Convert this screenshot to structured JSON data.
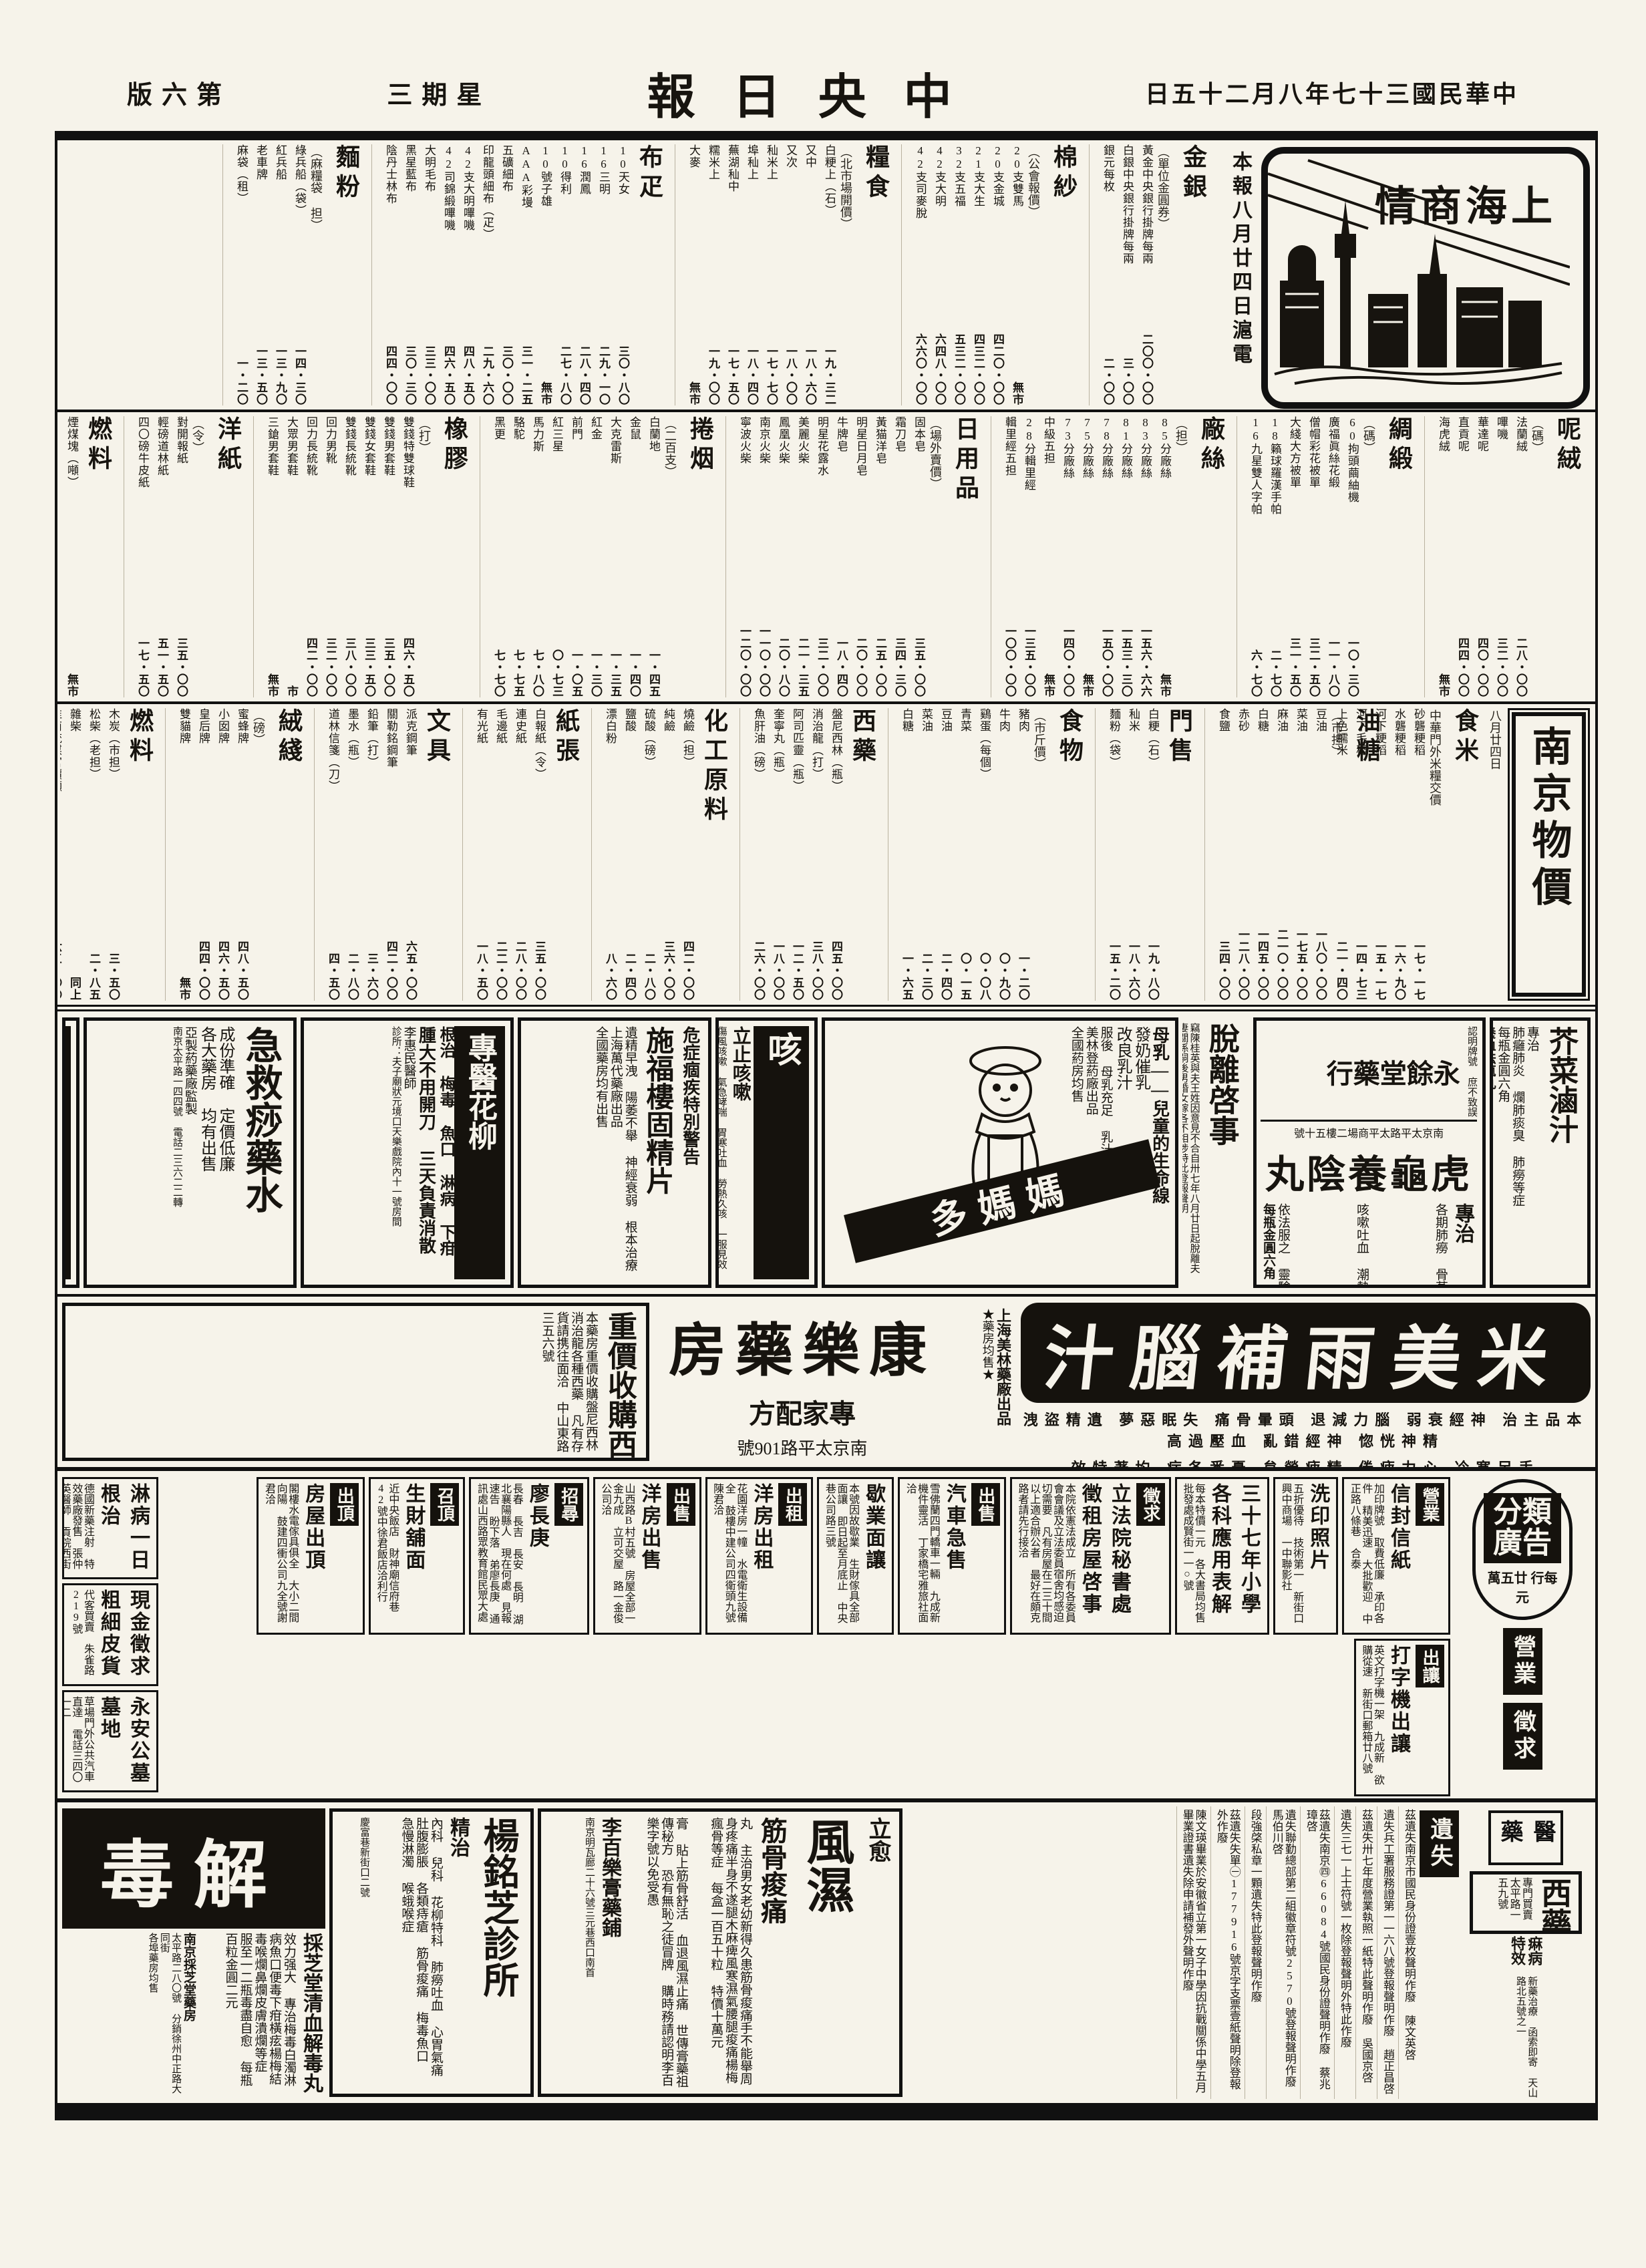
{
  "masthead": {
    "page": "第六版",
    "weekday": "星期三",
    "title": "中央日報",
    "date": "中華民國三十七年八月二十五日"
  },
  "shanghai": {
    "box_title": "上海商情",
    "dateline": "本報八月廿四日滬電"
  },
  "nanjing": {
    "box_title": "南京物價",
    "date": "八月廿四日",
    "sub": "食米",
    "note": "中華門外米糧交價",
    "items": [
      [
        "砂礱粳稻",
        "一七・一七"
      ],
      [
        "水礱粳稻",
        "一六・九〇"
      ],
      [
        "河下粳稻",
        "一五・一七"
      ],
      [
        "河下毛稻",
        "一四・七三"
      ],
      [
        "上色糯米",
        "二一・四〇"
      ]
    ]
  },
  "market": {
    "bands": [
      [
        {
          "t": "金銀",
          "n": "單位金圓券",
          "items": [
            [
              "黃金中央銀行掛牌每兩",
              "二〇〇・〇〇"
            ],
            [
              "白銀中央銀行掛牌每兩",
              "三・〇〇"
            ],
            [
              "銀元每枚",
              "二・〇〇"
            ]
          ]
        },
        {
          "t": "棉紗",
          "n": "公會報價",
          "items": [
            [
              "20支雙馬",
              "無市"
            ],
            [
              "20支金城",
              "四二〇・〇〇"
            ],
            [
              "21支大生",
              "四三二・〇〇"
            ],
            [
              "32支五福",
              "五三二・〇〇"
            ],
            [
              "42支大明",
              "六四八・〇〇"
            ],
            [
              "42支司麥脫",
              "六六〇・〇〇"
            ]
          ]
        },
        {
          "t": "糧食",
          "n": "北市場開價",
          "items": [
            [
              "白粳上（石）",
              "一九・三二"
            ],
            [
              "又中",
              "一八・六〇"
            ],
            [
              "又次",
              "一八・〇〇"
            ],
            [
              "秈米上",
              "一七・七〇"
            ],
            [
              "埠秈上",
              "一八・四〇"
            ],
            [
              "蕪湖秈中",
              "一七・五〇"
            ],
            [
              "糯米上",
              "一九・〇〇"
            ],
            [
              "大麥",
              "無市"
            ]
          ]
        },
        {
          "t": "布疋",
          "n": "",
          "items": [
            [
              "10天女",
              "三〇・八〇"
            ],
            [
              "16三明",
              "二九・一〇"
            ],
            [
              "16潤鳳",
              "二八・四〇"
            ],
            [
              "10得利",
              "二七・八〇"
            ],
            [
              "10號子雄",
              "無市"
            ],
            [
              "AAA彩墁",
              "三一・二五"
            ],
            [
              "五礦細布",
              "三〇・〇〇"
            ],
            [
              "印龍頭細布（疋）",
              "二九・六〇"
            ],
            [
              "42支大明嗶嘰",
              "四八・五〇"
            ],
            [
              "42司錦緞嗶嘰",
              "四六・五〇"
            ],
            [
              "大明毛布",
              "三三・〇〇"
            ],
            [
              "黑星藍布",
              "三〇・三〇"
            ],
            [
              "陰丹士林布",
              "四四・〇〇"
            ]
          ]
        },
        {
          "t": "麵粉",
          "n": "麻糧袋 担",
          "items": [
            [
              "綠兵船（袋）",
              "一四・三〇"
            ],
            [
              "紅兵船",
              "一三・九〇"
            ],
            [
              "老車牌",
              "一三・五〇"
            ],
            [
              "麻袋（租）",
              "一・二〇"
            ]
          ]
        }
      ],
      [
        {
          "t": "呢絨",
          "n": "碼",
          "items": [
            [
              "法蘭絨",
              "二八・〇〇"
            ],
            [
              "嗶嘰",
              "三二・〇〇"
            ],
            [
              "華達呢",
              "四〇・〇〇"
            ],
            [
              "直貢呢",
              "四四・〇〇"
            ],
            [
              "海虎絨",
              "無市"
            ]
          ]
        },
        {
          "t": "綢緞",
          "n": "碼",
          "items": [
            [
              "60拘頭繭紬機",
              "一〇・三〇"
            ],
            [
              "廣福眞絲花緞",
              "一一・八〇"
            ],
            [
              "僧帽彩花被單",
              "三二・五〇"
            ],
            [
              "大綫大方被單",
              "三一・五〇"
            ],
            [
              "18籟球羅漢手帕",
              "二・七〇"
            ],
            [
              "16九星雙人字帕",
              "六・七〇"
            ]
          ]
        },
        {
          "t": "廠絲",
          "n": "担",
          "items": [
            [
              "85分廠絲",
              "無市"
            ],
            [
              "83分廠絲",
              "一五六・六六"
            ],
            [
              "81分廠絲",
              "一五三・三〇"
            ],
            [
              "78分廠絲",
              "一五〇・〇〇"
            ],
            [
              "75分廠絲",
              "無市"
            ],
            [
              "73分廠絲",
              "一四〇・〇〇"
            ],
            [
              "中級五担",
              "無市"
            ],
            [
              "28分輯里經",
              "一三五・〇〇"
            ],
            [
              "輯里經五担",
              "一〇〇・〇〇"
            ]
          ]
        },
        {
          "t": "日用品",
          "n": "場外賣價",
          "items": [
            [
              "固本皂",
              "三五・〇〇"
            ],
            [
              "霜刀皂",
              "三四・三〇"
            ],
            [
              "黃猫洋皂",
              "二五・〇〇"
            ],
            [
              "明星日月皂",
              "二〇・〇〇"
            ],
            [
              "牛牌皂",
              "一八・四〇"
            ],
            [
              "明星花露水",
              "三二・〇〇"
            ],
            [
              "美麗火柴",
              "二一・三五"
            ],
            [
              "鳳凰火柴",
              "二〇・八〇"
            ],
            [
              "南京火柴",
              "一一〇・〇〇"
            ],
            [
              "寧波火柴",
              "一二〇・〇〇"
            ]
          ]
        },
        {
          "t": "捲烟",
          "n": "二百支",
          "items": [
            [
              "白蘭地",
              "一・四五"
            ],
            [
              "金鼠",
              "一・四〇"
            ],
            [
              "大克雷斯",
              "一・三五"
            ],
            [
              "紅金",
              "一・三〇"
            ],
            [
              "前門",
              "一・〇五"
            ],
            [
              "紅三星",
              "〇・七三"
            ],
            [
              "馬力斯",
              "七・八〇"
            ],
            [
              "駱駝",
              "七・七五"
            ],
            [
              "黑更",
              "七・七〇"
            ]
          ]
        },
        {
          "t": "橡膠",
          "n": "打",
          "items": [
            [
              "雙錢特雙球鞋",
              "四六・五〇"
            ],
            [
              "雙錢男套鞋",
              "三五・〇〇"
            ],
            [
              "雙錢女套鞋",
              "三三・五〇"
            ],
            [
              "雙錢長統靴",
              "三八・〇〇"
            ],
            [
              "回力男靴",
              "三二・〇〇"
            ],
            [
              "回力長統靴",
              "四二・〇〇"
            ],
            [
              "大眾男套鞋",
              "市"
            ],
            [
              "三鎗男套鞋",
              "無市"
            ]
          ]
        },
        {
          "t": "洋紙",
          "n": "令",
          "items": [
            [
              "對開報紙",
              "三五・〇〇"
            ],
            [
              "輕磅道林紙",
              "五一・五〇"
            ],
            [
              "四〇磅牛皮紙",
              "一七・五〇"
            ]
          ]
        },
        {
          "t": "燃料",
          "n": "",
          "items": [
            [
              "煙煤塊（噸）",
              "無市"
            ],
            [
              "烏炭（担）",
              "七・五〇"
            ],
            [
              "煤球（担）",
              "五・六〇"
            ],
            [
              "白炭（担）",
              "三六・七〇"
            ]
          ]
        },
        {
          "t": "無錫米麵",
          "n": "以上同行自報價",
          "big": true,
          "items": [
            [
              "白粳（石）開盤",
              "一八・九七"
            ],
            [
              "收盤",
              "一九・〇四"
            ],
            [
              "白麵（石）開盤",
              "一九・三三"
            ],
            [
              "門售",
              "一六・八五"
            ],
            [
              "白元（開盤）",
              "無市"
            ]
          ]
        }
      ],
      [
        {
          "t": "油糖",
          "n": "市担",
          "items": [
            [
              "豆油",
              "一八〇・〇〇"
            ],
            [
              "菜油",
              "一七五・〇〇"
            ],
            [
              "麻油",
              "二一〇・〇〇"
            ],
            [
              "白糖",
              "一四五・〇〇"
            ],
            [
              "赤砂",
              "一二八・〇〇"
            ],
            [
              "食鹽",
              "三四・〇〇"
            ]
          ]
        },
        {
          "t": "門售",
          "n": "",
          "items": [
            [
              "白粳（石）",
              "一九・八〇"
            ],
            [
              "秈米",
              "一八・六〇"
            ],
            [
              "麵粉（袋）",
              "一五・二〇"
            ]
          ]
        },
        {
          "t": "食物",
          "n": "市斤價",
          "items": [
            [
              "豬肉",
              "一・二〇"
            ],
            [
              "牛肉",
              "〇・九〇"
            ],
            [
              "鷄蛋（每個）",
              "〇・〇八"
            ],
            [
              "青菜",
              "〇・一五"
            ],
            [
              "豆油",
              "二・四〇"
            ],
            [
              "菜油",
              "二・三〇"
            ],
            [
              "白糖",
              "一・六五"
            ]
          ]
        },
        {
          "t": "西藥",
          "n": "",
          "items": [
            [
              "盤尼西林（瓶）",
              "四五・〇〇"
            ],
            [
              "消治龍（打）",
              "三八・〇〇"
            ],
            [
              "阿司匹靈（瓶）",
              "一二・五〇"
            ],
            [
              "奎寧丸（瓶）",
              "一八・〇〇"
            ],
            [
              "魚肝油（磅）",
              "二六・〇〇"
            ]
          ]
        },
        {
          "t": "化工原料",
          "n": "",
          "items": [
            [
              "燒鹼（担）",
              "四二・〇〇"
            ],
            [
              "純鹼",
              "三六・〇〇"
            ],
            [
              "硫酸（磅）",
              "二・八〇"
            ],
            [
              "鹽酸",
              "二・四〇"
            ],
            [
              "漂白粉",
              "八・六〇"
            ]
          ]
        },
        {
          "t": "紙張",
          "n": "",
          "items": [
            [
              "白報紙（令）",
              "三五・〇〇"
            ],
            [
              "連史紙",
              "二八・〇〇"
            ],
            [
              "毛邊紙",
              "二二・〇〇"
            ],
            [
              "有光紙",
              "一八・五〇"
            ]
          ]
        },
        {
          "t": "文具",
          "n": "",
          "items": [
            [
              "派克鋼筆",
              "六五・〇〇"
            ],
            [
              "關勒銘鋼筆",
              "四二・〇〇"
            ],
            [
              "鉛筆（打）",
              "三・六〇"
            ],
            [
              "墨水（瓶）",
              "二・八〇"
            ],
            [
              "道林信箋（刀）",
              "四・五〇"
            ]
          ]
        },
        {
          "t": "絨綫",
          "n": "磅",
          "items": [
            [
              "蜜蜂牌",
              "四八・五〇"
            ],
            [
              "小囡牌",
              "四六・五〇"
            ],
            [
              "皇后牌",
              "四四・〇〇"
            ],
            [
              "雙貓牌",
              "無市"
            ]
          ]
        },
        {
          "t": "燃料",
          "n": "",
          "items": [
            [
              "木炭（市担）",
              "三・五〇"
            ],
            [
              "松柴（老担）",
              "二・八五"
            ],
            [
              "雜柴",
              "同上"
            ],
            [
              "淮南統煤官價噸",
              "六三・〇〇"
            ],
            [
              "汽油（加侖）",
              "一〇・二〇"
            ],
            [
              "美孚火油（聽）",
              "一七・五〇"
            ]
          ]
        }
      ]
    ]
  },
  "ads": {
    "jiecai": {
      "title": "芥菜滷汁",
      "spec": "專治",
      "body": "肺癰肺炎 爛肺痰臭 肺癆等症",
      "price": "每瓶金圓六角",
      "extra_title": "養血祛瘋丸",
      "extra_body": "專治 筋骨痠痛 風濕麻木",
      "extra_price": "每瓶金圓六角"
    },
    "hugu": {
      "certify": "認明牌號 庶不致誤",
      "shop": "永餘堂藥行",
      "addr": "南京太平路太平商場二樓五十號",
      "product": "虎龜養陰丸",
      "spec": "專治",
      "list1": "各期肺癆 骨蒸盜汗 口乾舌燥 爛肺痰臭 氣急失眠 腰痠背痛 頭眩目花 百日童癆 夢遺滑精",
      "list2": "咳嗽吐血 潮熱顴紅 咽喉失音 肺痿胸脇悶痛 心跳食少 乾血女癆 一切虛癆串核",
      "note": "依法服之 靈驗如神",
      "price": "每瓶金圓六角"
    },
    "tuoli": {
      "title": "脫離啓事",
      "body": "竊陳桂英與夫王姓因意見不合自卅七年八月廿日起脫離夫妻關係嗣後男婚女嫁各不相涉特此登報聲明"
    },
    "mamado": {
      "slogan": "母乳——兒童的生命線",
      "brand": "媽媽多",
      "eff1": "發奶催乳",
      "eff2": "改良乳汁",
      "usage": "服後 母乳充足 乳汁濃厚",
      "maker": "美林登葯廠出品",
      "note": "全國葯房均售"
    },
    "cough": {
      "big": "咳",
      "title": "立止咳嗽",
      "body": "傷風咳嗽 氣急哮喘 胃寒吐血 勞熱久咳 一服見效",
      "maker": "上海中雅藥廠監製",
      "note": "各大藥房均售"
    },
    "shifulou": {
      "warn": "危症痼疾特別警告",
      "product": "施福樓固精片",
      "maker": "上海萬代藥廠出品",
      "body": "遺精早洩 陽萎不舉 神經衰弱 根本治療",
      "note": "全國藥房均有出售"
    },
    "zhuanyi": {
      "title": "專醫花柳",
      "cure": "根治 梅毒 魚口 淋病 下疳",
      "claim": "腫大不用開刀 三天負責消散",
      "doctor": "李惠民醫師",
      "addr": "診所：夫子廟狀元境口天樂戲院內十一號房間"
    },
    "jijiu": {
      "title": "急救痧藥水",
      "line1": "成份準確 定價低廉",
      "line2": "各大藥房 均有出售",
      "maker": "亞製葯藥廠監製",
      "addr": "南京太平路一四四號 電話二三六二二轉"
    },
    "baozhi": {
      "label1": "花柳淋濁",
      "label2": "包治",
      "cure": "根治 魚口 淋濁 梅毒 下疳 睾丸炎",
      "body": "急慢淋濁當天止濁 德國藥品內消 魚口橫痃大用藥內消",
      "addr": "診所中正路472號全日應診"
    },
    "minao": {
      "brand": "米美雨補腦汁",
      "line1": "本品主治 神經衰弱 腦力減退 頭暈骨痛 失眠惡夢 遺精盜洩 精神恍惚 神經錯亂 血壓過高",
      "line2": "手足寒冷 心力疲倦 精疲勞怠 憂悉各症 均著特效",
      "maker": "上海美林藥廠出品",
      "maker_note": "★藥房均售★"
    },
    "kangle": {
      "name": "康樂藥房",
      "line": "專家配方",
      "addr": "南京太平路109號"
    },
    "shougou": {
      "title": "重價收購西藥",
      "body": "本藥房重價收購盤尼西林消治龍各種西藥 凡有存貨請携往面洽 中山東路三五六號"
    },
    "caizhitang": {
      "jiedu": "解毒",
      "product": "採芝堂清血解毒丸",
      "body": "效力强大 專治梅毒白濁淋病魚口便毒下疳橫痃楊梅結毒喉爛鼻爛皮膚潰爛等症 服至一二瓶毒盡自愈 每瓶百粒金圓二元",
      "shop": "南京採芝堂藥房",
      "addr": "太平路二八〇號 分銷徐州中正路大同街",
      "note": "各埠藥房均售"
    },
    "yangmingzhi": {
      "name": "楊銘芝診所",
      "spec": "精治",
      "body": "內科 兒科 花柳特科 肺癆吐血 心胃氣痛 肚腹膨脹 各類痔瘡 筋骨痠痛 梅毒魚口 急慢淋濁 喉蛾喉症",
      "addr": "慶富巷新街口二號"
    },
    "fengshi": {
      "lead": "立愈",
      "big1": "風濕",
      "big2": "筋骨痠痛",
      "wan": "丸 主治男女老幼新得久患筋骨痠痛手不能舉周身疼痛半身不遂腿木麻痺風寒濕氣腰腿痠痛楊梅瘋骨等症 每盒一百五十粒 特價十萬元",
      "gao": "膏 貼上筋骨舒活 血退風濕止痛 世傳膏藥祖傳秘方 恐有無恥之徒冒牌 購時務請認明李百樂字號以免受愚",
      "shop": "李百樂膏藥鋪",
      "addr": "南京明瓦廊二十六號三元巷西口南首",
      "note": "各大藥房均售"
    }
  },
  "classifieds": {
    "rate_title": "分類廣告",
    "rate": "每行 廿五萬元",
    "tabs": [
      "營業",
      "徵求"
    ],
    "cells": [
      {
        "lab": "營業",
        "tit": "信封信紙",
        "body": "加印牌號 取費低廉 承印各件 精美迅速 大批歡迎 中正路八條巷 合泰"
      },
      {
        "lab": "",
        "tit": "洗印照片",
        "body": "五折優待 技術第一 新街口興中商場 一中聯影社"
      },
      {
        "lab": "",
        "tit": "三十七年小學各科應用表解",
        "body": "每本特價一元 各大書局均售 批發處成賢街一一○號"
      },
      {
        "lab": "徵求",
        "tit": "立法院秘書處徵租房屋啓事",
        "body": "本院依憲法成立 所有各委員會會議及立法委員宿舍均感迫切需要 凡有房屋在二三十間以上適合辦公者 最好在頗克路者請先行接洽"
      },
      {
        "lab": "出售",
        "tit": "汽車急售",
        "body": "雪佛蘭四門轎車一輛 九成新 機件靈活 丁家橋宅雅旅社面洽"
      },
      {
        "lab": "",
        "tit": "歇業面讓",
        "body": "本號因故歇業 生財傢具全部面讓 即日起至月底止 中央巷公司路三號"
      },
      {
        "lab": "出租",
        "tit": "洋房出租",
        "body": "花園洋房一幢 水電衛生設備全 鼓樓中建公司四衛頭九號陳君洽"
      },
      {
        "lab": "出售",
        "tit": "洋房出售",
        "body": "山西路B村五號 房屋全部一金九成 立可交屋 路一金俊公司洽"
      },
      {
        "lab": "招尋",
        "tit": "廖長庚",
        "body": "長春 長吉 長安 長明 湖北襄陽縣人 現在何處 見報速告 盼下落 弟廖長庚 通訊處山西路眾教育館民眾大處"
      },
      {
        "lab": "召頂",
        "tit": "生財舖面",
        "body": "近中央飯店 財神廟信府巷42號中徐君飯店洽利行"
      },
      {
        "lab": "出頂",
        "tit": "房屋出頂",
        "body": "閣樓水電傢具俱全 大小二間向陽 鼓建四衝公司九全號謝君洽"
      },
      {
        "lab": "出讓",
        "tit": "打字機出讓",
        "body": "英文打字機一架 九成新 欲購從速 新街口郵箱廿八號"
      }
    ],
    "left": [
      {
        "tit": "淋病一日根治",
        "body": "德國新藥注射 特效藥廠發售 張仲英醫師 貢院西街87號"
      },
      {
        "tit": "現金徵求 粗細皮貨",
        "body": "代客買賣 朱雀路219號"
      },
      {
        "tit": "永安公墓 墓地",
        "body": "草場門外公共汽車直達 電話三四〇一二"
      }
    ]
  },
  "rail2": {
    "yiyao": "醫藥",
    "xiyao_t": "西藥",
    "xiyao_n": "專門買賣",
    "xiyao_a": "太平路一五九號",
    "mabing_t": "痳病特效",
    "mabing_b": "新藥治療 函索即寄 天山路北五號之一",
    "lost_tab": "遺失"
  },
  "lost": [
    "茲遺失南京市國民身份證壹枚聲明作廢 陳文英啓",
    "遺失兵工署服務證第一一六八號登報聲明作廢 趙正昌啓",
    "茲遺失卅七年度營業執照一紙特此聲明作廢 吳國京啓",
    "遺失三七一上士符號一枚除登報聲明外特此作廢",
    "茲遺失南京㊃66084號國民身份證聲明作廢 蔡兆璋啓",
    "遺失聯勤總部第二組徽章符號2570號登報聲明作廢 馬伯川啓",
    "段強棨私章一顆遺失特此登報聲明作廢",
    "茲遺失失單㊀177916號京字支票壹紙聲明除登報外作廢",
    "陳文瑛畢業於安徽省立第一女子中學因抗戰關係中學五月畢業證書遺失除申請補發外聲明作廢"
  ]
}
